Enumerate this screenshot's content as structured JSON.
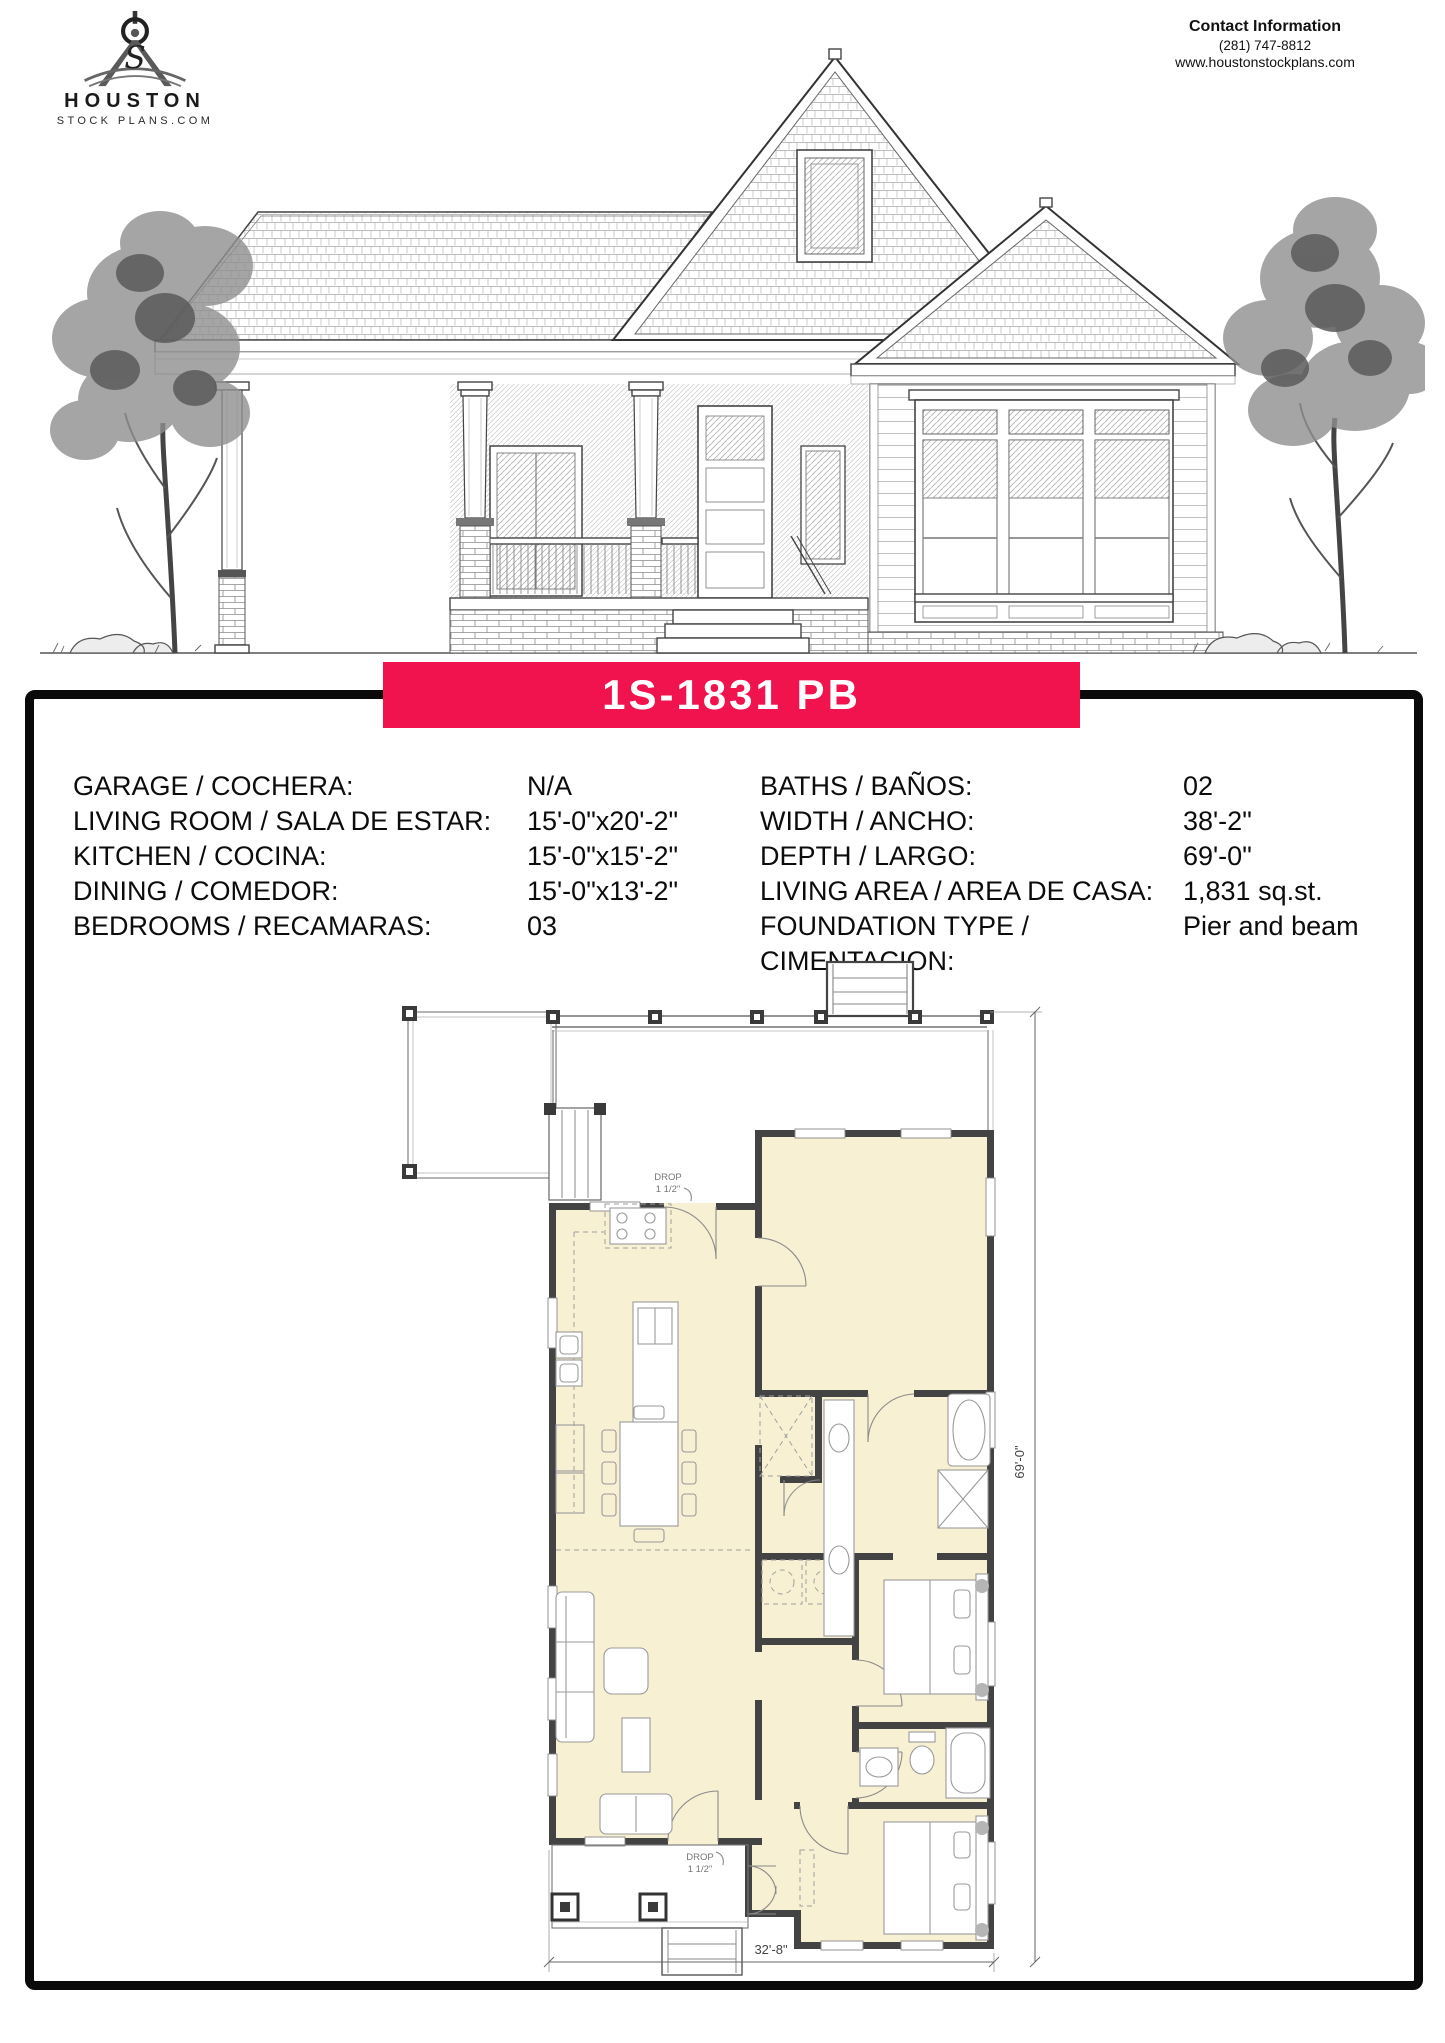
{
  "header": {
    "logo": {
      "line1": "HOUSTON",
      "line2": "STOCK PLANS.COM",
      "icon": "drafting-compass-icon"
    },
    "contact": {
      "title": "Contact Information",
      "phone": "(281) 747-8812",
      "website": "www.houstonstockplans.com"
    }
  },
  "plan_banner": {
    "title": "1S-1831 PB",
    "bg": "#F0134D",
    "text_color": "#ffffff"
  },
  "specs": {
    "left": [
      {
        "label": "GARAGE / COCHERA:",
        "value": "N/A"
      },
      {
        "label": "LIVING ROOM / SALA DE ESTAR:",
        "value": "15'-0\"x20'-2\""
      },
      {
        "label": "KITCHEN / COCINA:",
        "value": "15'-0\"x15'-2\""
      },
      {
        "label": "DINING / COMEDOR:",
        "value": "15'-0\"x13'-2\""
      },
      {
        "label": "BEDROOMS / RECAMARAS:",
        "value": "03"
      }
    ],
    "right": [
      {
        "label": "BATHS / BAÑOS:",
        "value": "02"
      },
      {
        "label": "WIDTH / ANCHO:",
        "value": "38'-2\""
      },
      {
        "label": "DEPTH / LARGO:",
        "value": "69'-0\""
      },
      {
        "label": "LIVING AREA / AREA DE CASA:",
        "value": "1,831 sq.st."
      },
      {
        "label": "FOUNDATION TYPE /",
        "value": "Pier and beam"
      },
      {
        "label": "CIMENTACION:",
        "value": ""
      }
    ]
  },
  "floor_plan": {
    "width_dim": "32'-8\"",
    "depth_dim": "69'-0\"",
    "drop_note_line1": "DROP",
    "drop_note_line2": "1 1/2\"",
    "room_fill": "#F8F0D3",
    "wall_color": "#434343"
  }
}
